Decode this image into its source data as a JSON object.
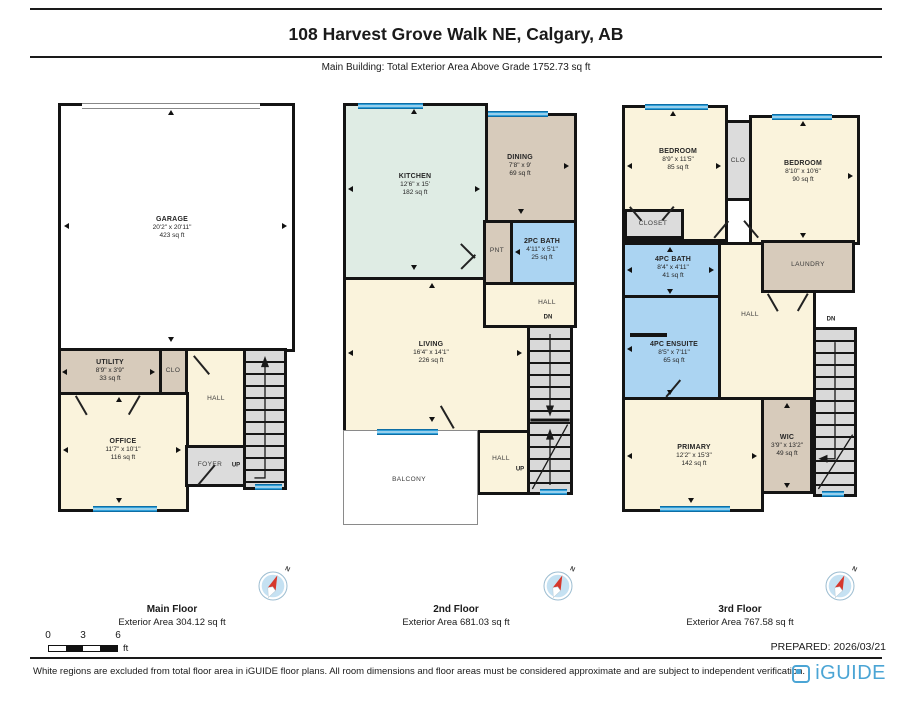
{
  "page": {
    "title": "108 Harvest Grove Walk NE, Calgary, AB",
    "subtitle": "Main Building: Total Exterior Area Above Grade 1752.73 sq ft",
    "prepared": "PREPARED: 2026/03/21",
    "disclaimer": "White regions are excluded from total floor area in iGUIDE floor plans. All room dimensions and floor areas must be considered approximate and are subject to independent verification.",
    "brand": "iGUIDE",
    "compass_label": "N"
  },
  "scale_bar": {
    "ticks": [
      "0",
      "3",
      "6"
    ],
    "unit": "ft"
  },
  "floors": [
    {
      "name": "Main Floor",
      "area": "Exterior Area 304.12 sq ft",
      "rooms": [
        {
          "label": "GARAGE",
          "dims": "20'2\" x 20'11\"",
          "area": "423 sq ft"
        },
        {
          "label": "UTILITY",
          "dims": "8'9\" x 3'9\"",
          "area": "33 sq ft"
        },
        {
          "label": "CLO"
        },
        {
          "label": "HALL"
        },
        {
          "label": "OFFICE",
          "dims": "11'7\" x 10'1\"",
          "area": "116 sq ft"
        },
        {
          "label": "FOYER"
        },
        {
          "label": "UP"
        }
      ]
    },
    {
      "name": "2nd Floor",
      "area": "Exterior Area 681.03 sq ft",
      "rooms": [
        {
          "label": "KITCHEN",
          "dims": "12'6\" x 15'",
          "area": "182 sq ft"
        },
        {
          "label": "DINING",
          "dims": "7'8\" x 9'",
          "area": "69 sq ft"
        },
        {
          "label": "PNT"
        },
        {
          "label": "2PC BATH",
          "dims": "4'11\" x 5'1\"",
          "area": "25 sq ft"
        },
        {
          "label": "HALL"
        },
        {
          "label": "DN"
        },
        {
          "label": "LIVING",
          "dims": "16'4\" x 14'1\"",
          "area": "226 sq ft"
        },
        {
          "label": "HALL"
        },
        {
          "label": "UP"
        },
        {
          "label": "BALCONY"
        }
      ]
    },
    {
      "name": "3rd Floor",
      "area": "Exterior Area 767.58 sq ft",
      "rooms": [
        {
          "label": "BEDROOM",
          "dims": "8'9\" x 11'5\"",
          "area": "85 sq ft"
        },
        {
          "label": "CLO"
        },
        {
          "label": "BEDROOM",
          "dims": "8'10\" x 10'6\"",
          "area": "90 sq ft"
        },
        {
          "label": "CLOSET"
        },
        {
          "label": "4PC BATH",
          "dims": "8'4\" x 4'11\"",
          "area": "41 sq ft"
        },
        {
          "label": "LAUNDRY"
        },
        {
          "label": "HALL"
        },
        {
          "label": "DN"
        },
        {
          "label": "4PC ENSUITE",
          "dims": "8'5\" x 7'11\"",
          "area": "65 sq ft"
        },
        {
          "label": "PRIMARY",
          "dims": "12'2\" x 15'3\"",
          "area": "142 sq ft"
        },
        {
          "label": "WIC",
          "dims": "3'9\" x 13'2\"",
          "area": "49 sq ft"
        }
      ]
    }
  ],
  "colors": {
    "wall": "#141414",
    "room_cream": "#faf3dc",
    "room_tan": "#d7cbbb",
    "room_mint": "#dfece4",
    "room_blue": "#abd4f2",
    "room_gray": "#dcdcdc",
    "window_blue": "#2f9fd9",
    "brand_blue": "#4ba5d5"
  }
}
